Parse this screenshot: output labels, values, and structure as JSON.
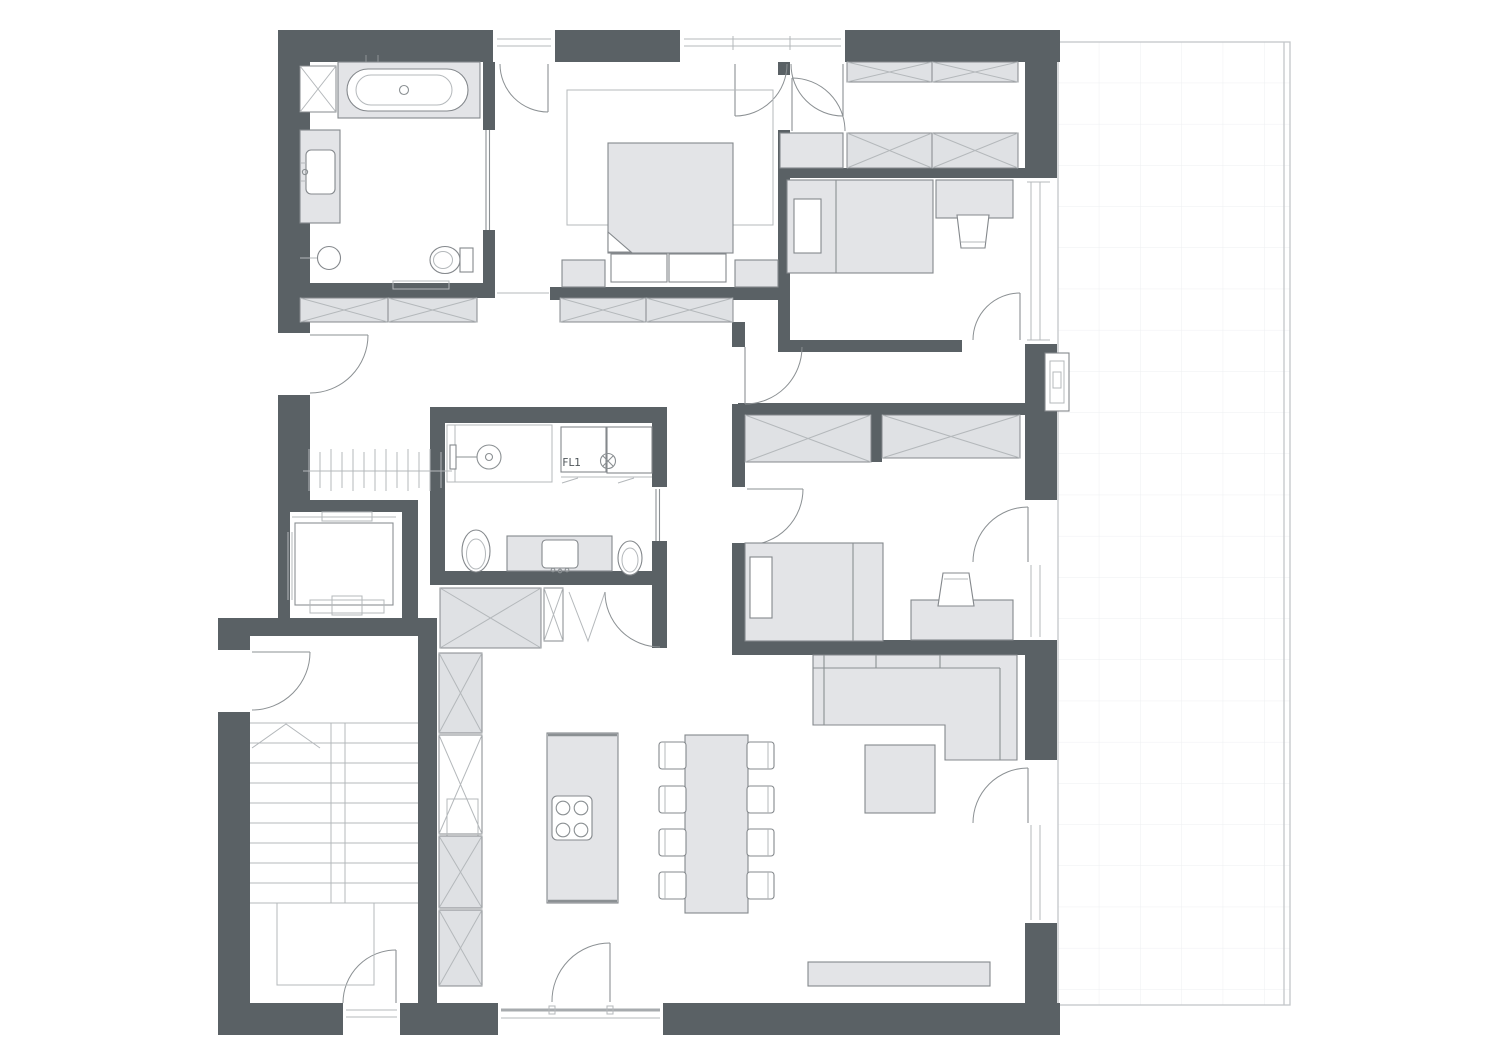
{
  "plan": {
    "type": "architectural-floor-plan",
    "title": "Apartment floor plan with terrace",
    "labels": {
      "floor_drain": "FL1"
    },
    "rooms": [
      {
        "name": "Bathroom (en-suite)",
        "items": [
          "tall-cabinet-x",
          "bathtub",
          "vanity-counter-with-sink",
          "round-basin",
          "toilet",
          "bath-mat",
          "pocket-door"
        ]
      },
      {
        "name": "Master bedroom",
        "items": [
          "area-rug",
          "double-bed",
          "folded-blanket-corner",
          "pillow-left",
          "pillow-right",
          "nightstand-left",
          "nightstand-right",
          "french-balcony-doors",
          "tilt-window"
        ]
      },
      {
        "name": "Walk-in closet",
        "items": [
          "wardrobe-row-top",
          "wardrobe-row-bottom",
          "dresser",
          "door-from-master"
        ]
      },
      {
        "name": "Bedroom 1",
        "items": [
          "single-bed",
          "pillow",
          "desk",
          "chair",
          "terrace-window",
          "door"
        ]
      },
      {
        "name": "Corridor",
        "items": [
          "door-from-hall"
        ]
      },
      {
        "name": "Bedroom 2",
        "items": [
          "wardrobe-left",
          "wardrobe-right",
          "single-bed",
          "pillow",
          "desk",
          "chair",
          "terrace-door-with-window"
        ]
      },
      {
        "name": "Bathroom 2",
        "items": [
          "shower",
          "washer",
          "dryer",
          "floor-drain-FL1",
          "toilet",
          "vanity-with-sink",
          "wc",
          "pocket-door"
        ]
      },
      {
        "name": "Entry hall",
        "items": [
          "entry-door",
          "coat-rack",
          "wardrobe-row-a",
          "wardrobe-row-b"
        ]
      },
      {
        "name": "Elevator",
        "items": [
          "shaft",
          "cab",
          "sliding-door",
          "counterweight",
          "guide-rails"
        ]
      },
      {
        "name": "Staircase",
        "items": [
          "treads",
          "center-stringer",
          "walk-line-arrow",
          "lower-landing",
          "entrance-door",
          "side-door"
        ]
      },
      {
        "name": "Kitchen / dining",
        "items": [
          "island-with-cooktop",
          "cooktop-4-burner",
          "tall-cabinet-column",
          "storage-closet-x",
          "narrow-closet-x",
          "bifold-closet",
          "dining-table",
          "chairs-x8",
          "terrace-door"
        ]
      },
      {
        "name": "Living room",
        "items": [
          "corner-sofa",
          "coffee-table",
          "tv-sideboard",
          "terrace-door-with-window"
        ]
      },
      {
        "name": "Terrace",
        "items": [
          "tile-grid",
          "wall-light",
          "railing-edge"
        ]
      }
    ],
    "openings": {
      "windows": [
        "master-french-window-north",
        "master-tilt-window-north",
        "bedroom1-window-east",
        "bedroom2-window-east",
        "living-room-window-east",
        "kitchen-window-south"
      ],
      "doors": [
        "entry-door-west",
        "stairwell-side-door-west",
        "stairwell-entrance-south",
        "kitchen-terrace-door-south",
        "living-terrace-door-east",
        "bedroom2-terrace-door-east",
        "bedroom1-door",
        "bedroom2-door",
        "corridor-door",
        "master-closet-door",
        "bathroom1-pocket-door",
        "bathroom2-pocket-door",
        "closet-bifold-door"
      ]
    }
  },
  "colors": {
    "wall": "#5a6165",
    "furniture_fill": "#e3e4e7",
    "cabinet_fill": "#dfe1e4",
    "furniture_stroke": "#84888c",
    "line": "#8b9093",
    "light_line": "#b4b8bb",
    "grid": "#edeff1",
    "terrace_border": "#c3c6c9",
    "text": "#4e5559"
  }
}
